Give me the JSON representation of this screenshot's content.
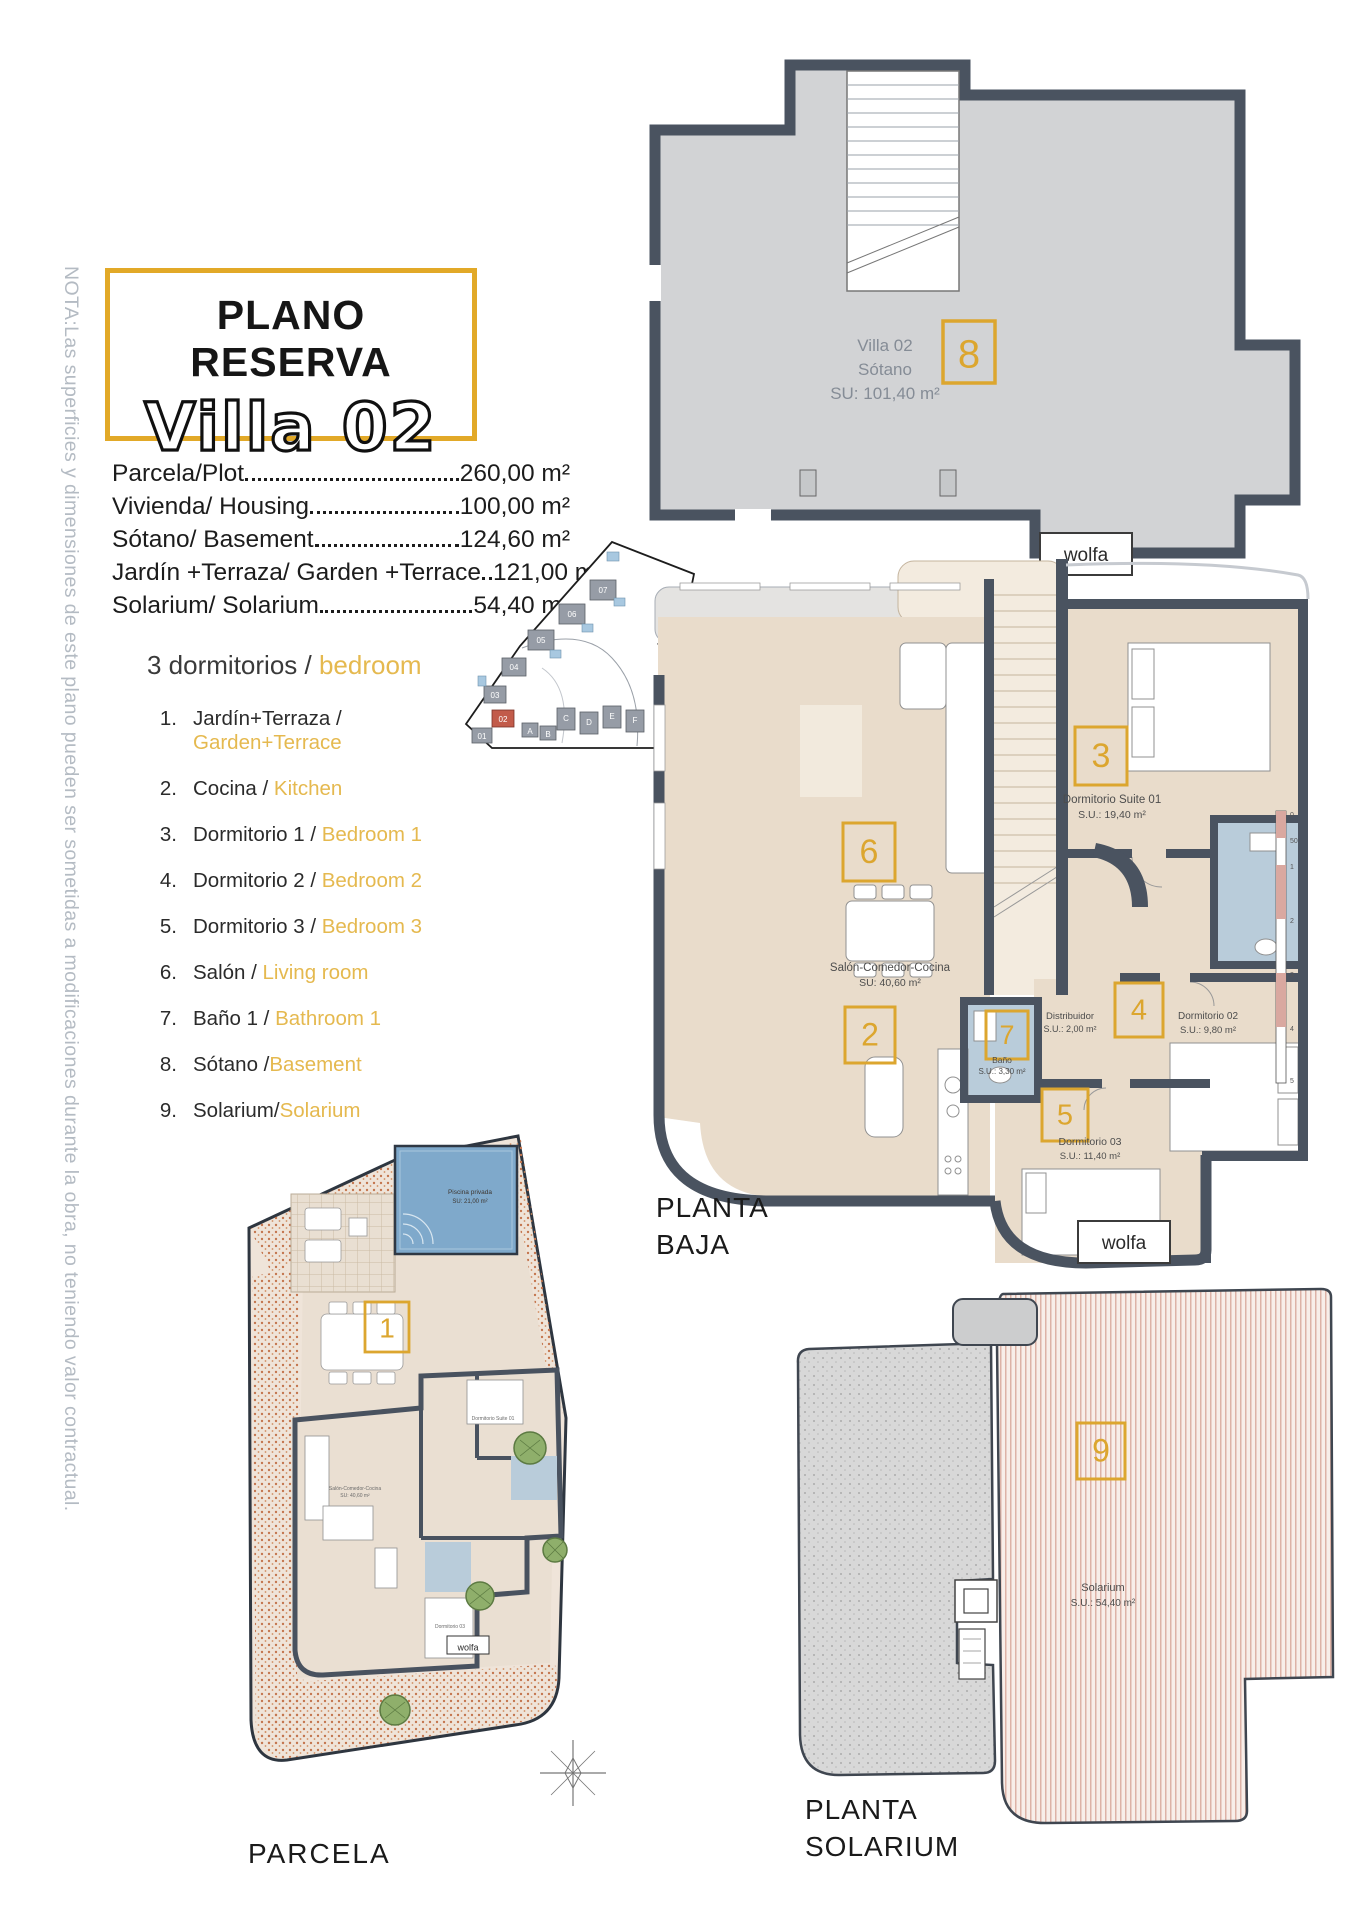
{
  "note_vertical": "NOTA:Las superficies y dimensiones de este plano pueden ser sometidas a modificaciones durante la obra, no teniendo valor contractual.",
  "title": {
    "line1": "PLANO RESERVA",
    "line2": "Villa 02"
  },
  "areas": {
    "rows": [
      {
        "label": "Parcela/Plot",
        "value": "260,00 m²"
      },
      {
        "label": "Vivienda/ Housing",
        "value": "100,00 m²"
      },
      {
        "label": "Sótano/ Basement",
        "value": "124,60 m²"
      },
      {
        "label": "Jardín +Terraza/ Garden +Terrace",
        "value": "121,00 m²"
      },
      {
        "label": "Solarium/ Solarium",
        "value": "54,40 m²"
      }
    ]
  },
  "legend": {
    "heading_es": "3 dormitorios / ",
    "heading_en": "bedroom",
    "items": [
      {
        "num": "1.",
        "es": "Jardín+Terraza / ",
        "en": "Garden+Terrace"
      },
      {
        "num": "2.",
        "es": "Cocina / ",
        "en": "Kitchen"
      },
      {
        "num": "3.",
        "es": "Dormitorio 1 / ",
        "en": "Bedroom 1"
      },
      {
        "num": "4.",
        "es": "Dormitorio 2 / ",
        "en": "Bedroom 2"
      },
      {
        "num": "5.",
        "es": "Dormitorio 3 / ",
        "en": "Bedroom 3"
      },
      {
        "num": "6.",
        "es": "Salón / ",
        "en": "Living room"
      },
      {
        "num": "7.",
        "es": "Baño 1 / ",
        "en": "Bathroom 1"
      },
      {
        "num": "8.",
        "es": "Sótano /",
        "en": "Basement"
      },
      {
        "num": "9.",
        "es": "Solarium/",
        "en": "Solarium"
      }
    ]
  },
  "plans": {
    "sotano": {
      "caption1": "PLANTA",
      "caption2": "SÓTANO",
      "label1": "Villa 02",
      "label2": "Sótano",
      "label3": "SU: 101,40 m²",
      "badge": "8",
      "brand": "wolfa"
    },
    "baja": {
      "caption1": "PLANTA",
      "caption2": "BAJA",
      "brand": "wolfa",
      "salon_name": "Salón-Comedor-Cocina",
      "salon_area": "SU: 40,60 m²",
      "salon_badge": "6",
      "suite_name": "Dormitorio Suite 01",
      "suite_area": "S.U.: 19,40 m²",
      "suite_badge": "3",
      "cocina_badge": "2",
      "bano_name": "Baño",
      "bano_area": "S.U.: 3,30 m²",
      "bano_badge": "7",
      "distribuidor_name": "Distribuidor",
      "distribuidor_area": "S.U.: 2,00 m²",
      "dorm2_name": "Dormitorio 02",
      "dorm2_area": "S.U.: 9,80 m²",
      "dorm2_badge": "4",
      "dorm3_name": "Dormitorio 03",
      "dorm3_area": "S.U.: 11,40 m²",
      "dorm3_badge": "5",
      "scale_ticks": [
        "0",
        "50",
        "1",
        "2",
        "3",
        "4",
        "5"
      ]
    },
    "parcela": {
      "caption": "PARCELA",
      "badge": "1",
      "brand": "wolfa",
      "pool_name": "Piscina privada",
      "pool_area": "SU: 21,00 m²"
    },
    "solarium": {
      "caption1": "PLANTA",
      "caption2": "SOLARIUM",
      "badge": "9",
      "name": "Solarium",
      "area": "S.U.: 54,40 m²"
    }
  },
  "sitemap": {
    "labels": [
      "07",
      "06",
      "05",
      "04",
      "03",
      "02",
      "01",
      "A",
      "B",
      "C",
      "D",
      "E",
      "F"
    ]
  },
  "colors": {
    "accent": "#E2A928",
    "badge_gold": "#DCA62F",
    "legend_gold": "#E5B94F",
    "wall": "#4A5360",
    "basement_floor": "#D2D3D5",
    "floor": "#E9DCCB",
    "bath": "#B9CCDA",
    "pool": "#7FA9CB",
    "note_gray": "#b4bbc3"
  }
}
